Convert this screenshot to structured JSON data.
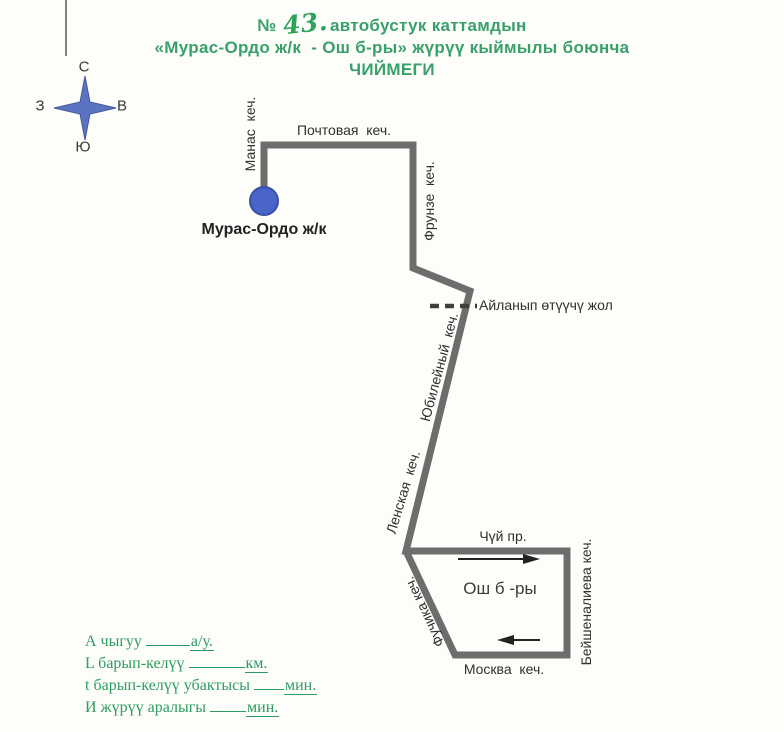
{
  "title": {
    "number_sign": "№",
    "route_number": "43.",
    "line1_rest": "автобустук каттамдын",
    "line2": "«Мурас-Ордо ж/к  - Ош б-ры» жүрүү кыймылы боюнча",
    "line3": "ЧИЙМЕГИ"
  },
  "compass": {
    "north": "С",
    "south": "Ю",
    "east": "В",
    "west": "З"
  },
  "map": {
    "start_stop_label": "Мурас-Ордо ж/к",
    "detour_label": "Айланып өтүүчү жол",
    "loop_label": "Ош б -ры",
    "streets": {
      "manas": "Манас  кеч.",
      "pochtovaya": "Почтовая  кеч.",
      "frunze": "Фрунзе  кеч.",
      "yubileyny": "Юбилейный  кеч.",
      "lenskaya": "Ленская  кеч.",
      "chuy": "Чүй пр.",
      "fuchika": "Фучика кеч.",
      "moskva": "Москва  кеч.",
      "beyshenalieva": "Бейшеналиева кеч."
    }
  },
  "legend": {
    "lines": [
      {
        "label": "А чыгуу ",
        "unit": "а/у."
      },
      {
        "label": "L барып-келүү ",
        "unit": "км."
      },
      {
        "label": "t барып-келүү убактысы ",
        "unit": "мин."
      },
      {
        "label": "И жүрүү аралыгы ",
        "unit": "мин."
      }
    ]
  },
  "colors": {
    "title_green": "#3aa06b",
    "legend_green": "#2e9c62",
    "route_gray": "#6d6d6d",
    "stop_blue": "#4a65c9",
    "stop_blue_border": "#3a4fa8",
    "compass_blue": "#5b74c2",
    "compass_blue_border": "#46589c",
    "arrow_black": "#222222",
    "dash_dark": "#3f3f3f"
  }
}
